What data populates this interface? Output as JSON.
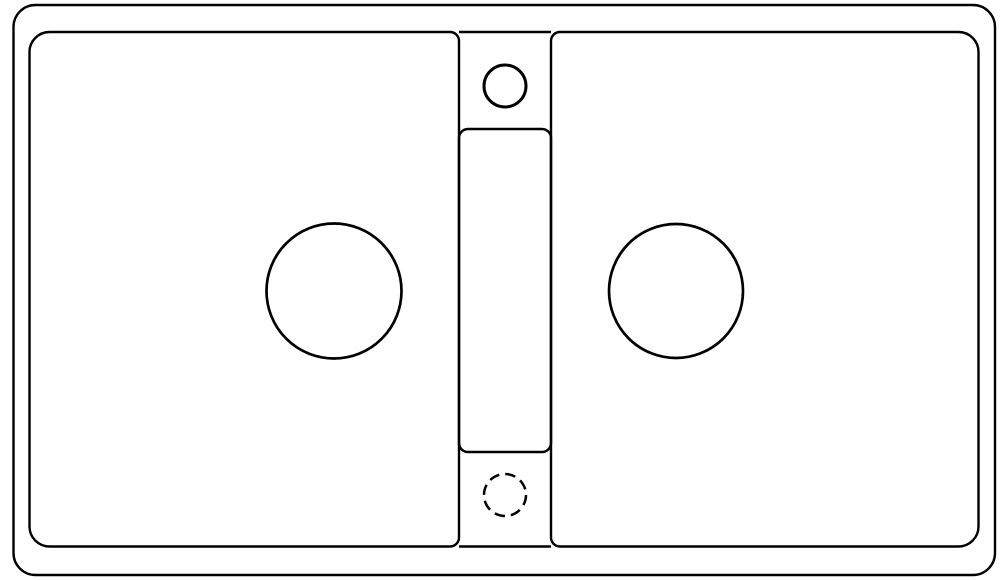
{
  "canvas": {
    "width": 1000,
    "height": 581,
    "background_color": "#ffffff",
    "stroke_color": "#000000"
  },
  "drawing": {
    "description": "line drawing, top view of double-bowl sink",
    "outer_rim": {
      "x": 13.5,
      "y": 5,
      "width": 981.5,
      "height": 570,
      "radius": 22,
      "stroke_width": 2.4
    },
    "left_basin": {
      "x": 29.5,
      "y": 32,
      "width": 429.5,
      "height": 514.5,
      "r_top_left": 20,
      "r_top_right": 9,
      "r_bottom_right": 9,
      "r_bottom_left": 20,
      "stroke_width": 2.4
    },
    "right_basin": {
      "x": 551,
      "y": 32,
      "width": 427.5,
      "height": 514.5,
      "r_top_left": 9,
      "r_top_right": 20,
      "r_bottom_right": 20,
      "r_bottom_left": 9,
      "stroke_width": 2.4
    },
    "divider_top_edge": {
      "x1": 459,
      "y1": 32,
      "x2": 551,
      "y2": 32,
      "stroke_width": 2.4
    },
    "divider_bottom_edge": {
      "x1": 459,
      "y1": 546.5,
      "x2": 551,
      "y2": 546.5,
      "stroke_width": 2.4
    },
    "center_panel": {
      "x": 459,
      "y": 129,
      "width": 92,
      "height": 323,
      "radius": 9,
      "stroke_width": 2.5
    },
    "faucet_hole": {
      "cx": 505,
      "cy": 86,
      "r": 21,
      "stroke_width": 3
    },
    "knockout_hole": {
      "cx": 505,
      "cy": 495,
      "r": 21,
      "stroke_width": 2.5,
      "dash": "10.5 6"
    },
    "left_drain_hole": {
      "cx": 334,
      "cy": 291,
      "r": 67.5,
      "stroke_width": 2.7
    },
    "right_drain_hole": {
      "cx": 676,
      "cy": 291,
      "r": 67,
      "stroke_width": 2.7
    }
  }
}
